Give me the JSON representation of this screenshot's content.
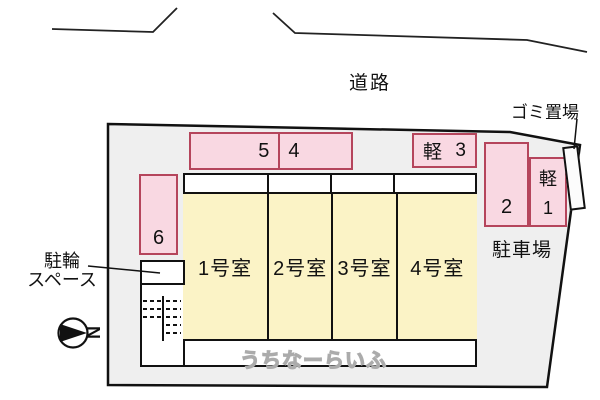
{
  "colors": {
    "site_fill": "#efefef",
    "room_fill": "#fbf3c6",
    "parking_fill": "#f9d8e2",
    "parking_border": "#b5455c"
  },
  "road": {
    "label": "道路"
  },
  "garbage": {
    "label": "ゴミ置場"
  },
  "parking_lot": {
    "label": "駐車場",
    "space5": "5",
    "space4": "4",
    "kei3": {
      "kei": "軽",
      "num": "3"
    },
    "space2": "2",
    "kei1": {
      "kei": "軽",
      "num": "1"
    },
    "space6": "6"
  },
  "bicycle": {
    "label_line1": "駐輪",
    "label_line2": "スペース"
  },
  "building": {
    "rooms": [
      {
        "label": "1号室"
      },
      {
        "label": "2号室"
      },
      {
        "label": "3号室"
      },
      {
        "label": "4号室"
      }
    ]
  },
  "compass": {
    "letter": "N"
  },
  "watermark": {
    "text": "うちなーらいふ"
  }
}
